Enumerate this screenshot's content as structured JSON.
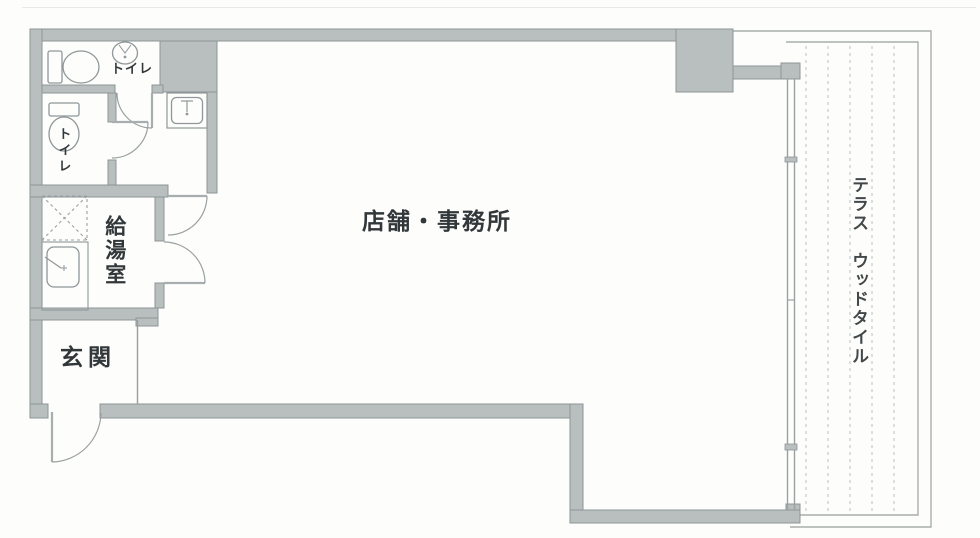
{
  "floor_plan": {
    "rooms": {
      "main_room": {
        "label": "店舗・事務所"
      },
      "toilet_top": {
        "label": "トイレ"
      },
      "toilet_left": {
        "label": "トイレ"
      },
      "kitchenette": {
        "label": "給湯室"
      },
      "entrance": {
        "label": "玄関"
      },
      "terrace": {
        "label": "テラス　ウッドタイル"
      }
    },
    "icons": [
      "toilet-icon",
      "hand-basin-icon",
      "wash-basin-icon",
      "kitchen-sink-icon",
      "water-heater-hatch-icon",
      "door-swing-arc",
      "sliding-window-icon"
    ],
    "colors": {
      "wall_fill": "#b9bfbe",
      "wall_edge": "#8d9597",
      "line": "#979ea0",
      "tile_dash": "#c5cbca",
      "text": "#32383a",
      "background": "#fdfdfb"
    }
  }
}
